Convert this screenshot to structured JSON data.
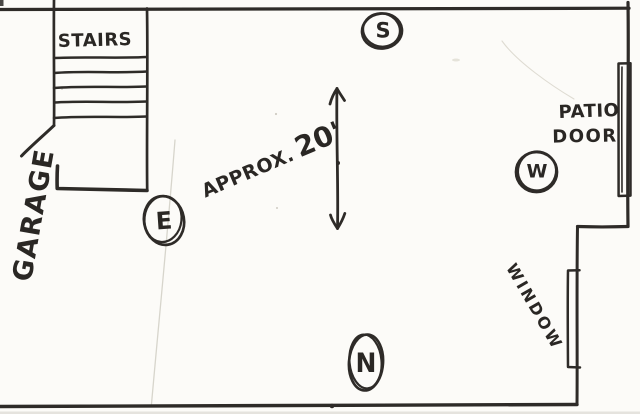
{
  "floor_plan": {
    "stairs_label": "STAIRS",
    "garage_label": "GARAGE",
    "dimension": {
      "prefix": "APPROX.",
      "value": "20'"
    },
    "patio_door": {
      "line1": "PATIO",
      "line2": "DOOR"
    },
    "window_label": "WINDOW",
    "compass": {
      "south": "S",
      "east": "E",
      "west": "W",
      "north": "N"
    }
  },
  "colors": {
    "ink": "#2e2b28",
    "paper": "#fcfbf8",
    "faint_line": "#d7d5cc"
  }
}
